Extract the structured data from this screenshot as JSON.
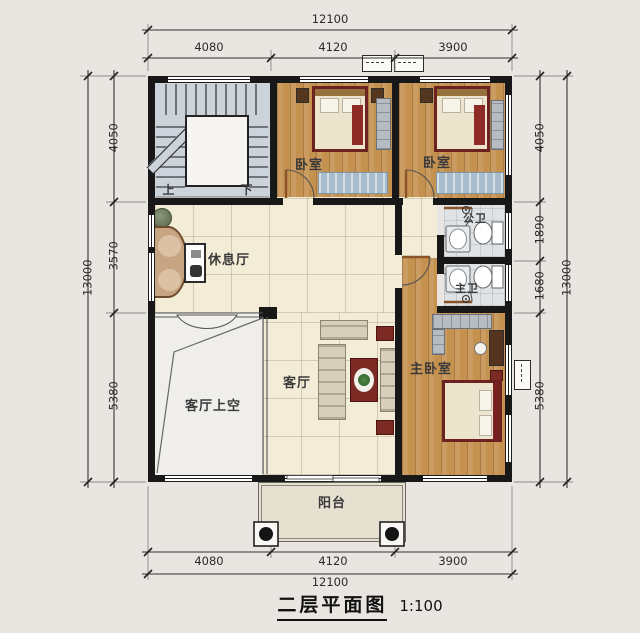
{
  "title": {
    "text": "二层平面图",
    "scale": "1:100"
  },
  "dimensions": {
    "top": {
      "total": "12100",
      "segments": [
        "4080",
        "4120",
        "3900"
      ]
    },
    "bottom": {
      "total": "12100",
      "segments": [
        "4080",
        "4120",
        "3900"
      ]
    },
    "left": {
      "total": "13000",
      "segments": [
        "4050",
        "3570",
        "5380"
      ]
    },
    "right": {
      "total": "13000",
      "segments": [
        "4050",
        "1890",
        "1680",
        "5380"
      ]
    }
  },
  "rooms": {
    "bedroom_left": "卧室",
    "bedroom_right": "卧室",
    "public_bathroom": "公卫",
    "master_bathroom": "主卫",
    "lounge": "休息厅",
    "living_room": "客厅",
    "living_room_void": "客厅上空",
    "master_bedroom": "主卧室",
    "balcony": "阳台"
  },
  "stairs": {
    "up": "上",
    "down": "下"
  },
  "icons": {
    "ac_unit": "ac-unit",
    "lamp": "ceiling-lamp",
    "toilet": "toilet",
    "sink": "sink",
    "plant": "plant"
  },
  "colors": {
    "wall": "#181818",
    "wood_floor": "#c5914f",
    "tile_floor": "#f3ecd7",
    "accent_red": "#7c2a24"
  }
}
